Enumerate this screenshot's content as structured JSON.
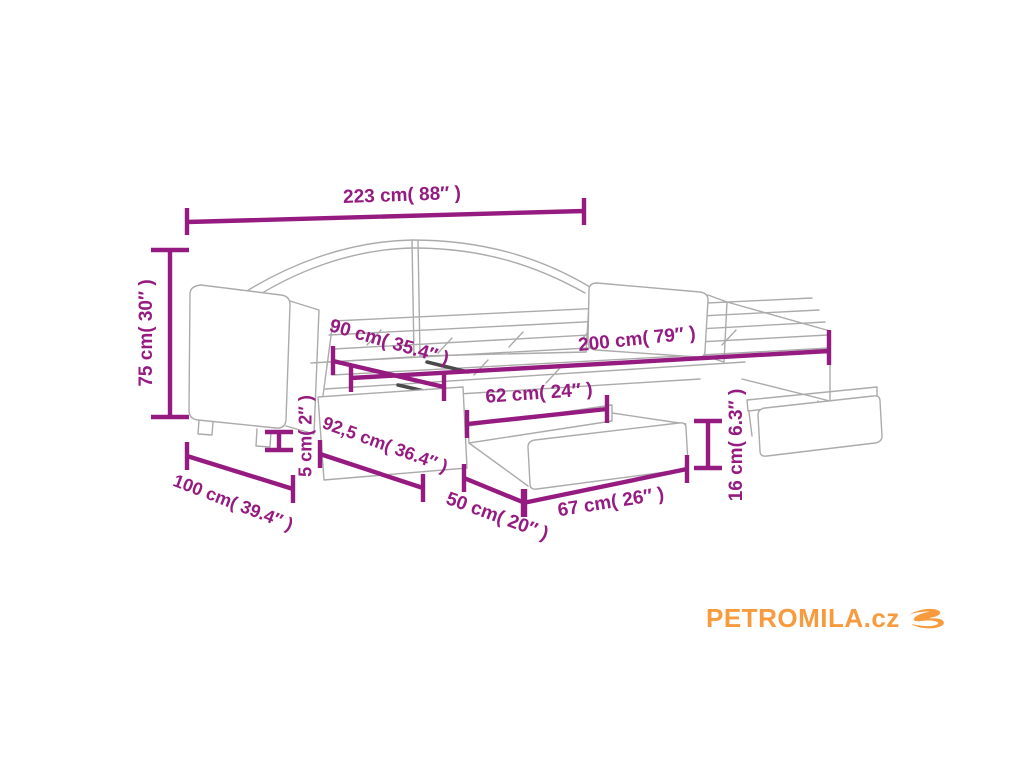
{
  "colors": {
    "dimension_magenta": "#951b81",
    "drawing_gray": "#ababab",
    "logo_orange": "#f89a3e"
  },
  "diagram": {
    "dimensions": [
      {
        "id": "total-width",
        "label": "223 cm( 88″ )"
      },
      {
        "id": "total-height",
        "label": "75 cm( 30″ )"
      },
      {
        "id": "bed-width",
        "label": "90 cm( 35.4″ )"
      },
      {
        "id": "bed-length",
        "label": "200 cm( 79″ )"
      },
      {
        "id": "drawer-inner-width",
        "label": "62 cm( 24″ )"
      },
      {
        "id": "trundle-depth",
        "label": "92,5 cm( 36.4″ )"
      },
      {
        "id": "leg-height",
        "label": "5 cm( 2″ )"
      },
      {
        "id": "side-depth",
        "label": "100 cm( 39.4″ )"
      },
      {
        "id": "drawer-side-depth",
        "label": "50 cm( 20″ )"
      },
      {
        "id": "drawer-front-width",
        "label": "67 cm( 26″ )"
      },
      {
        "id": "drawer-height",
        "label": "16 cm( 6.3″ )"
      }
    ]
  },
  "branding": {
    "logo_text": "PETROMILA.cz"
  }
}
